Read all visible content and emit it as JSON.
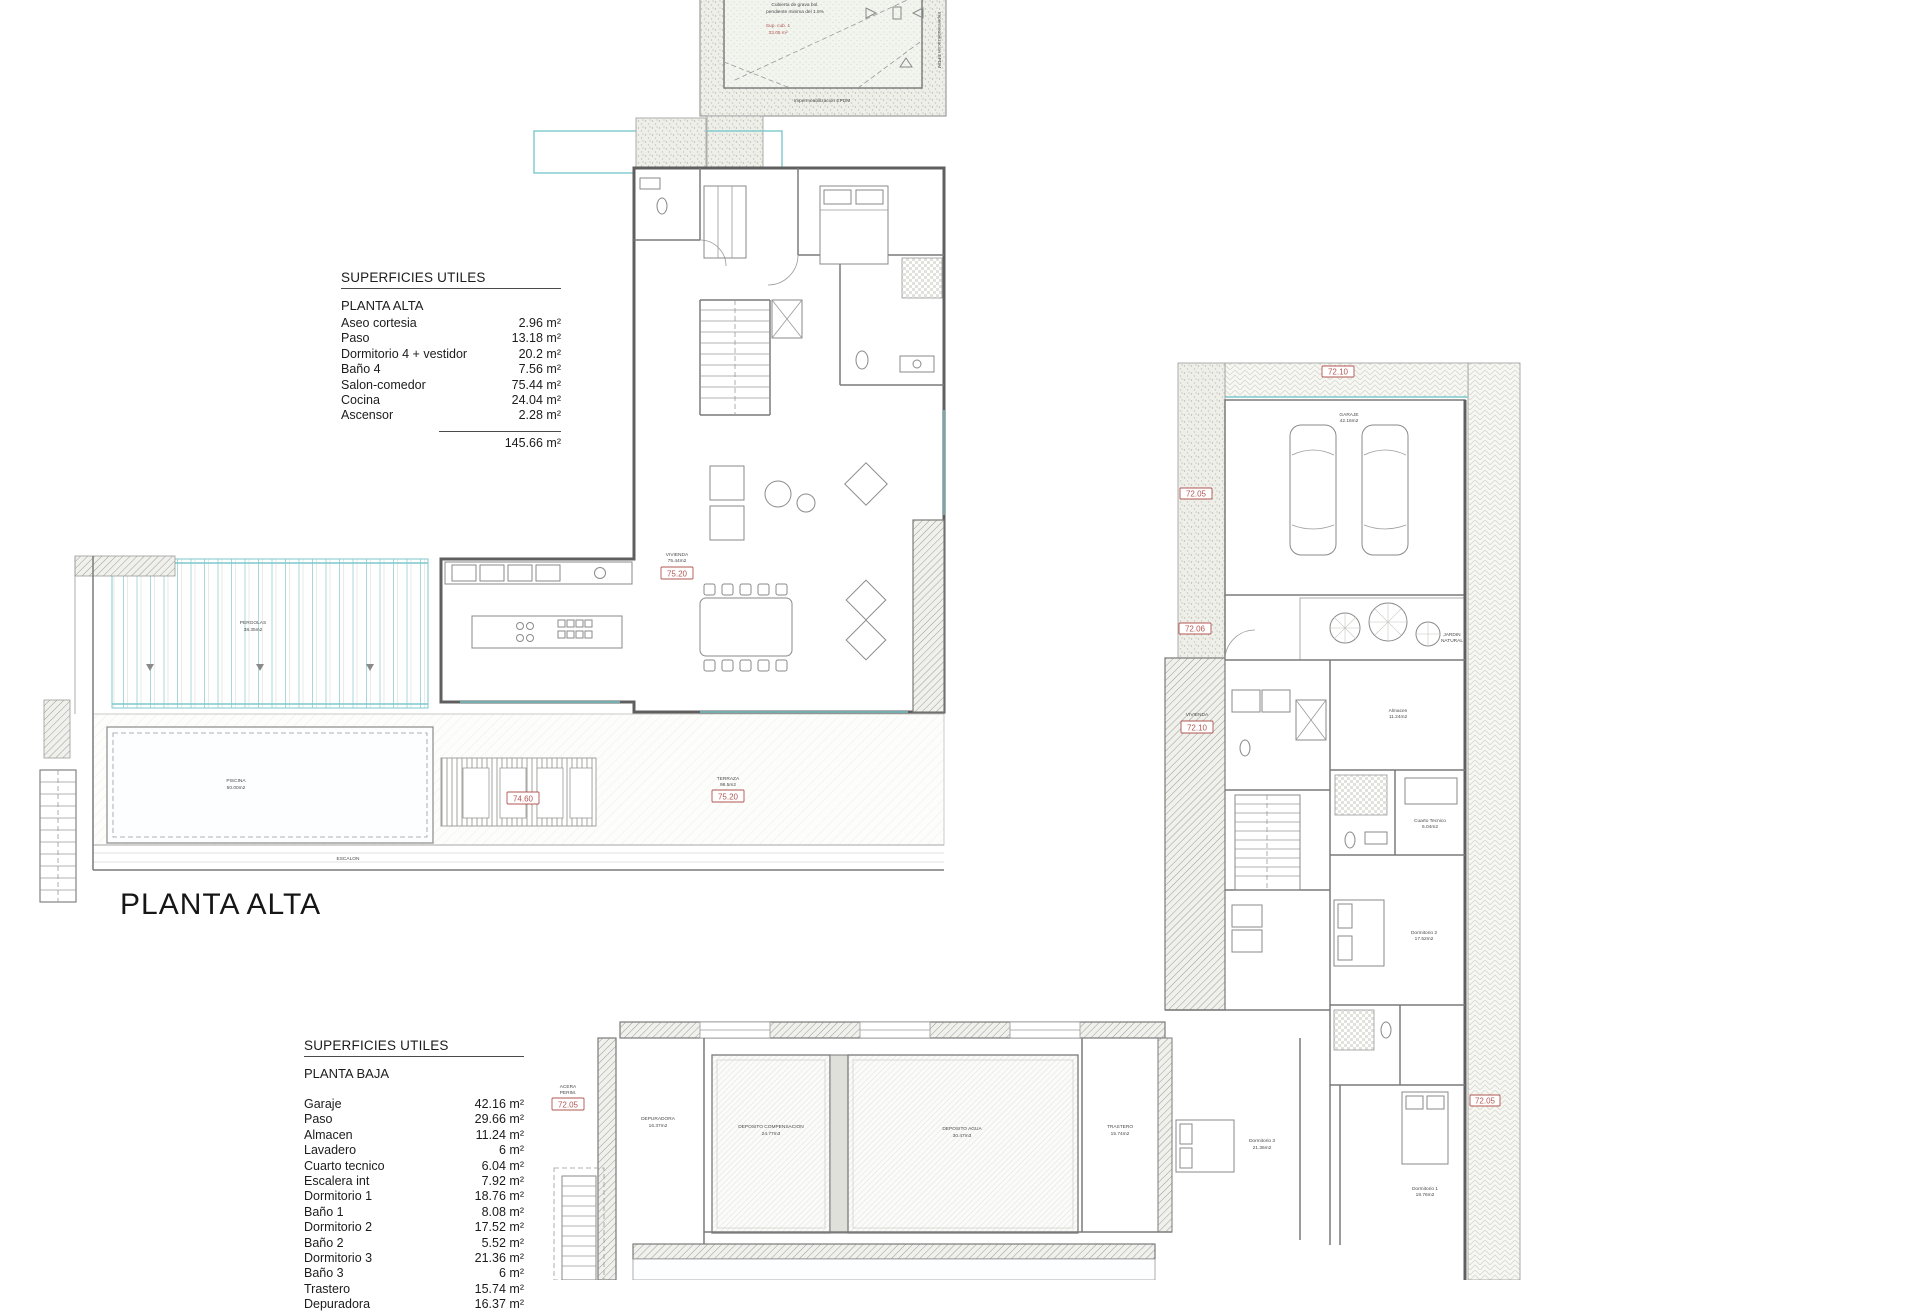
{
  "colors": {
    "accent_red": "#b05552",
    "teal": "#7cc9cc",
    "wall_gray": "#5f5f5f"
  },
  "titles": {
    "planta_alta": "PLANTA ALTA"
  },
  "tables": {
    "planta_alta": {
      "header": "SUPERFICIES UTILES",
      "subtitle": "PLANTA ALTA",
      "rows": [
        {
          "label": "Aseo cortesia",
          "value": "2.96 m²"
        },
        {
          "label": "Paso",
          "value": "13.18 m²"
        },
        {
          "label": "Dormitorio 4 + vestidor",
          "value": "20.2 m²"
        },
        {
          "label": "Baño 4",
          "value": "7.56 m²"
        },
        {
          "label": "Salon-comedor",
          "value": "75.44 m²"
        },
        {
          "label": "Cocina",
          "value": "24.04 m²"
        },
        {
          "label": "Ascensor",
          "value": "2.28 m²"
        }
      ],
      "total": "145.66 m²"
    },
    "planta_baja": {
      "header": "SUPERFICIES UTILES",
      "subtitle": "PLANTA BAJA",
      "rows": [
        {
          "label": "Garaje",
          "value": "42.16 m²"
        },
        {
          "label": "Paso",
          "value": "29.66 m²"
        },
        {
          "label": "Almacen",
          "value": "11.24 m²"
        },
        {
          "label": "Lavadero",
          "value": "6 m²"
        },
        {
          "label": "Cuarto tecnico",
          "value": "6.04 m²"
        },
        {
          "label": "Escalera int",
          "value": "7.92 m²"
        },
        {
          "label": "Dormitorio 1",
          "value": "18.76 m²"
        },
        {
          "label": "Baño 1",
          "value": "8.08 m²"
        },
        {
          "label": "Dormitorio 2",
          "value": "17.52 m²"
        },
        {
          "label": "Baño 2",
          "value": "5.52 m²"
        },
        {
          "label": "Dormitorio 3",
          "value": "21.36 m²"
        },
        {
          "label": "Baño 3",
          "value": "6 m²"
        },
        {
          "label": "Trastero",
          "value": "15.74 m²"
        },
        {
          "label": "Depuradora",
          "value": "16.37 m²"
        }
      ]
    }
  },
  "roof": {
    "note1": "Cubierta de grava bol.",
    "note2": "pendiente minima del 1.5%",
    "sup1": "Sup. cub. 1",
    "sup2": "33.05 m²",
    "bottom": "Impermeabilizacion EPDM",
    "side": "Impermeabilizacion EPDM"
  },
  "levels": {
    "vivienda_alta": "75.20",
    "terraza": "75.20",
    "sunbed": "74.60",
    "garaje_top": "72.10",
    "entry_a": "72.05",
    "entry_b": "72.06",
    "vivienda_baja": "72.10",
    "side_strip": "72.05",
    "acera": "72.05"
  },
  "plan_labels": {
    "vivienda_alta": {
      "l1": "VIVIENDA",
      "l2": "75.44m2"
    },
    "terraza": {
      "l1": "TERRAZA",
      "l2": "98.5m2"
    },
    "pergolas": {
      "l1": "PERGOLAS",
      "l2": "38.35m2"
    },
    "piscina": {
      "l1": "PISCINA",
      "l2": "50.00m2"
    },
    "escalon": "ESCALON",
    "garaje": {
      "l1": "GARAJE",
      "l2": "42.16m2"
    },
    "jardin": {
      "l1": "JARDIN",
      "l2": "NATURAL"
    },
    "vivienda_baja": {
      "l1": "VIVIENDA"
    },
    "almacen": {
      "l1": "Almacen",
      "l2": "11.24m2"
    },
    "cuarto_tecnico": {
      "l1": "Cuarto Tecnico",
      "l2": "6.04m2"
    },
    "dormitorio1": {
      "l1": "Dormitorio 1",
      "l2": "18.76m2"
    },
    "dormitorio2": {
      "l1": "Dormitorio 2",
      "l2": "17.52m2"
    },
    "dormitorio3": {
      "l1": "Dormitorio 3",
      "l2": "21.36m2"
    },
    "trastero": {
      "l1": "TRASTERO",
      "l2": "15.74m2"
    },
    "depuradora": {
      "l1": "DEPURADORA",
      "l2": "16.37m2"
    },
    "dep_comp": {
      "l1": "DEPOSITO COMPENSACION",
      "l2": "24.77m3"
    },
    "dep_agua": {
      "l1": "DEPOSITO AGUA",
      "l2": "30.47m3"
    },
    "acera": {
      "l1": "ACERA",
      "l2": "PERIM."
    }
  }
}
